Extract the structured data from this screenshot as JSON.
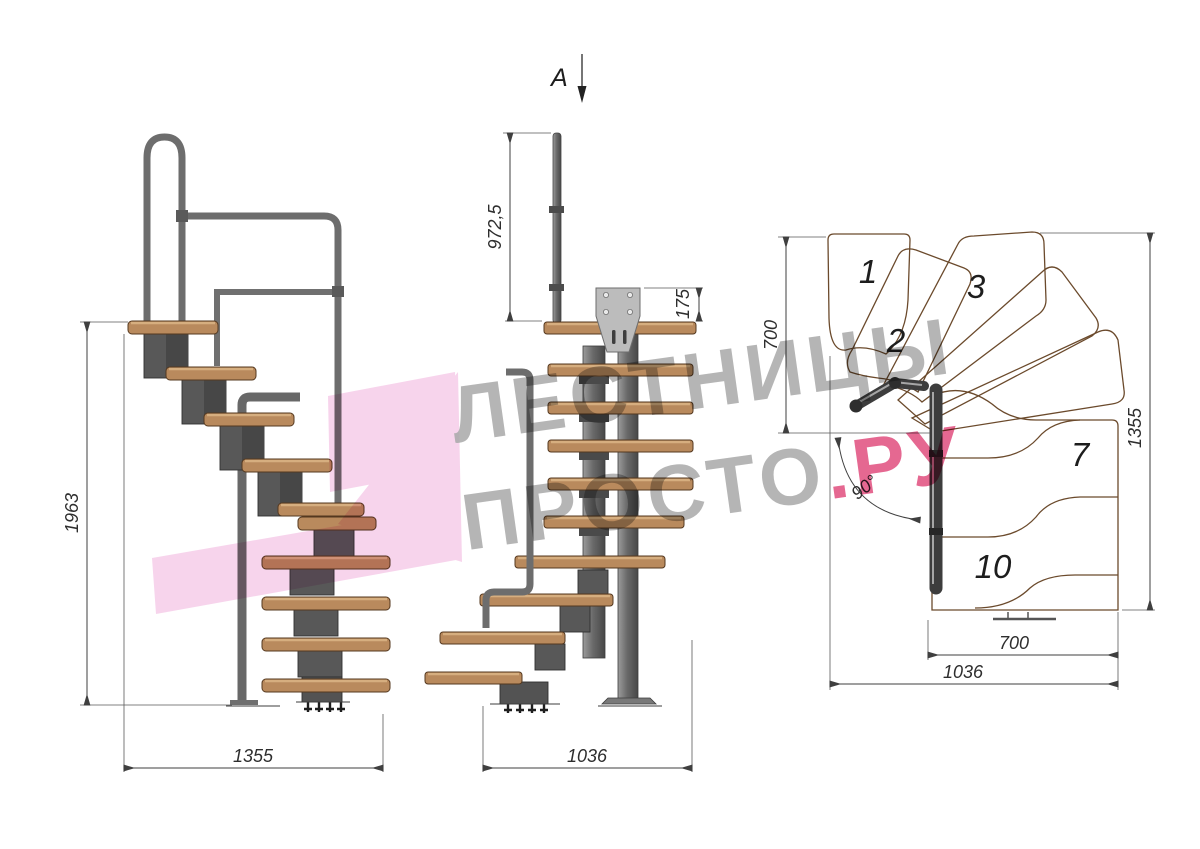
{
  "watermark": {
    "line1": "ЛЕСТНИЦЫ",
    "line2": "ПРОСТО",
    "line2_accent": ".РУ",
    "gray": "#a9a9a9",
    "pink": "#e14e7e",
    "logo_pink": "#f0a9da"
  },
  "section_marker": {
    "label": "A"
  },
  "views": {
    "side": {
      "dims": {
        "height": "1963",
        "width": "1355"
      }
    },
    "front": {
      "dims": {
        "post_height": "972,5",
        "bracket_offset": "175",
        "width": "1036"
      }
    },
    "plan": {
      "dims": {
        "upper_depth": "700",
        "flight_length": "1355",
        "tread_width": "700",
        "total_width": "1036",
        "turn_angle": "90°"
      },
      "steps": {
        "s1": "1",
        "s2": "2",
        "s3": "3",
        "s7": "7",
        "s10": "10"
      }
    }
  },
  "colors": {
    "wood": "#c49066",
    "wood_face": "#b98a5d",
    "metal": "#5f5f5f",
    "steel_plate": "#bcbcbc",
    "dim_line": "#3f3f3f",
    "background": "#ffffff"
  }
}
